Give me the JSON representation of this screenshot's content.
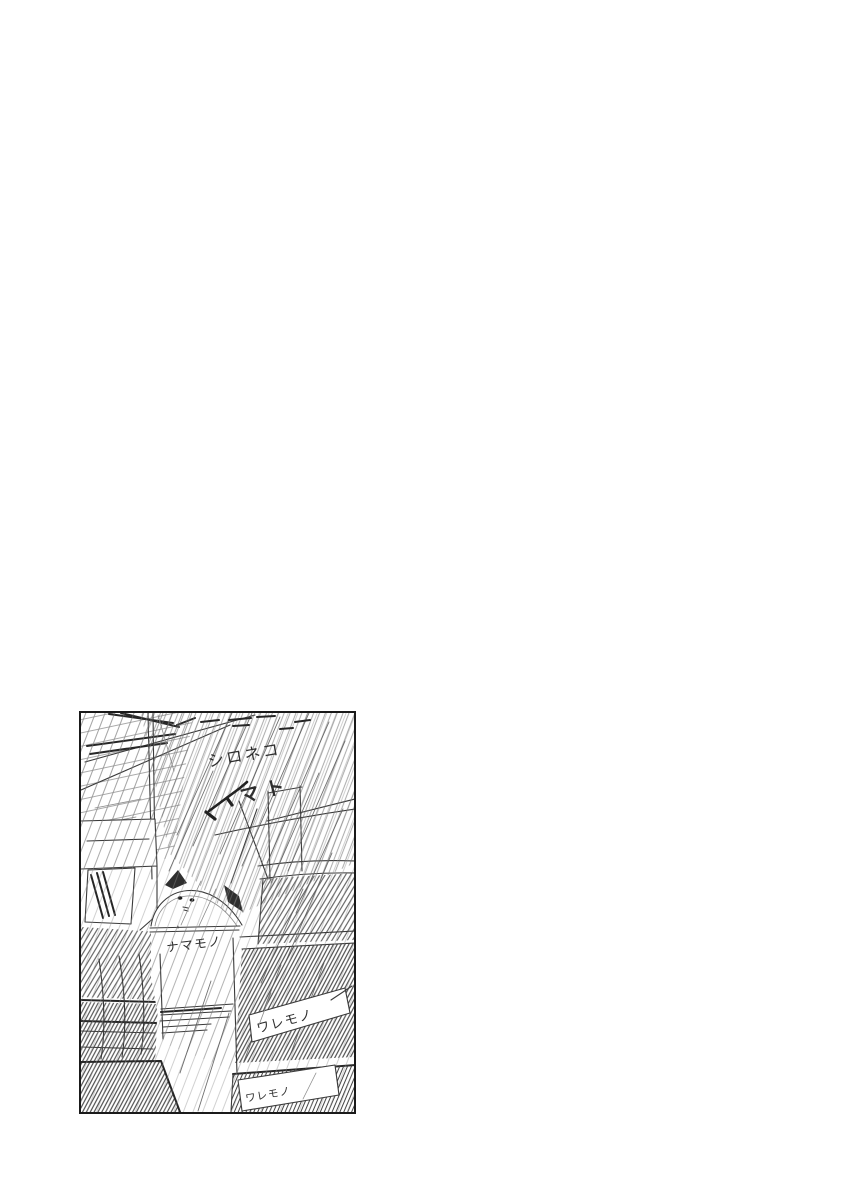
{
  "page": {
    "background_color": "#ffffff"
  },
  "sketch_panel": {
    "border_color": "#1a1a1a",
    "pencil_color": "#3a3a3a",
    "scene": "rough-pencil-sketch-white-cat-in-crate-rainy-alley",
    "annotations": {
      "caption_line1": "シロネコ",
      "caption_line2": "マト",
      "perishable_label": "ナマモノ",
      "fragile_label_right": "ワレモノ",
      "fragile_label_bottom": "ワレモノ"
    }
  }
}
